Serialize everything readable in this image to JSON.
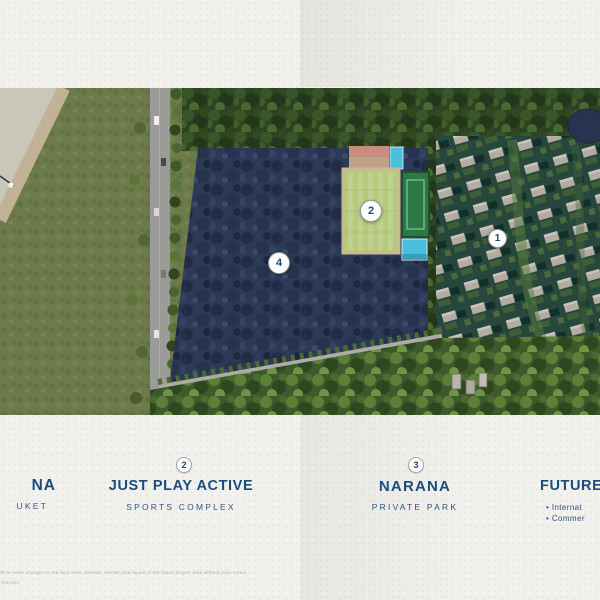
{
  "colors": {
    "accent_navy": "#1d4c7b",
    "paper": "#f1f0ec",
    "park_navy": "#2d3a57",
    "field_green": "#b6ca7d",
    "pool_cyan": "#49bedd"
  },
  "map": {
    "markers": [
      {
        "label": "1"
      },
      {
        "label": "2"
      },
      {
        "label": "4"
      }
    ]
  },
  "legend": {
    "item_left": {
      "title_fragment": "NA",
      "subtitle_fragment": "UKET"
    },
    "item_sports": {
      "number": "2",
      "title": "JUST PLAY ACTIVE",
      "subtitle": "SPORTS COMPLEX"
    },
    "item_park": {
      "number": "3",
      "title": "NARANA",
      "subtitle": "PRIVATE PARK"
    },
    "item_future": {
      "title_fragment": "FUTURE",
      "bullet1_fragment": "• Internat",
      "bullet2_fragment": "• Commer"
    }
  },
  "disclaimer": {
    "line1": "ght to make changes to the land area, concept, master plan layout of the future project area without prior notice,",
    "line2": "r reasons."
  }
}
